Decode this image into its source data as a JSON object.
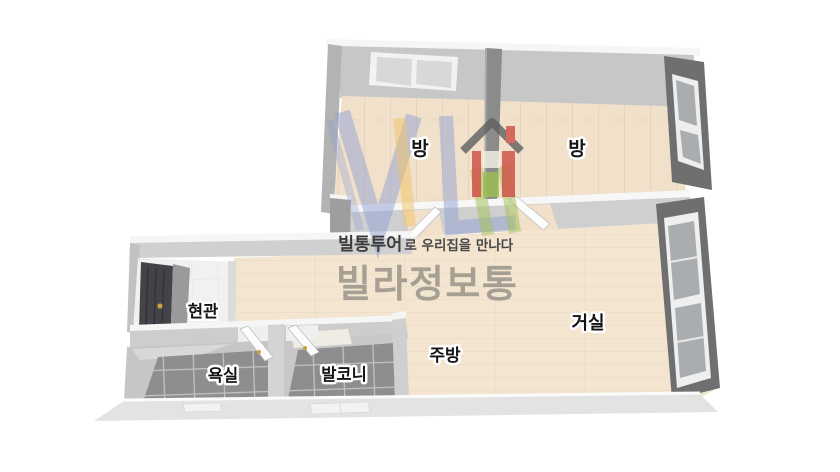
{
  "page": {
    "type": "3d-floorplan-image",
    "background": "#ffffff"
  },
  "watermark": {
    "tagline_brand": "빌통투어",
    "tagline_rest": "로 우리집을 만나다",
    "brand_name": "빌라정보통",
    "logo": "villa-info-house-logo"
  },
  "floorplan": {
    "rooms": [
      {
        "id": "bedroom-left",
        "label": "방"
      },
      {
        "id": "bedroom-right",
        "label": "방"
      },
      {
        "id": "entrance",
        "label": "현관"
      },
      {
        "id": "bathroom",
        "label": "욕실"
      },
      {
        "id": "balcony",
        "label": "발코니"
      },
      {
        "id": "kitchen",
        "label": "주방"
      },
      {
        "id": "living-room",
        "label": "거실"
      }
    ],
    "features": [
      "window-top-bedroom-left",
      "window-right-bedroom-right",
      "window-right-living-room",
      "front-door-entrance",
      "open-door-bathroom",
      "open-door-balcony",
      "door-opening-bedroom-left",
      "door-opening-bedroom-right"
    ]
  },
  "colors": {
    "wall_light": "#cfcfcf",
    "wall_top_edge": "#f7f7f7",
    "wall_dark_window": "#6f6f6f",
    "wood_floor": "#f1e0ca",
    "wood_floor_living": "#f3e5d0",
    "tile_floor": "#8e8e8e",
    "tile_grout": "#c2c2c2",
    "entrance_floor": "#f1f1f1",
    "front_door": "#43444a",
    "door_handle_gold": "#c9a23c",
    "logo_blue": "#8fa0d4",
    "logo_yellow": "#f0c468",
    "logo_green": "#a4c25c",
    "logo_red": "#cf4c44",
    "brand_text": "#9c968c",
    "tagline_text": "#3c3c3c",
    "label_text": "#141414"
  }
}
